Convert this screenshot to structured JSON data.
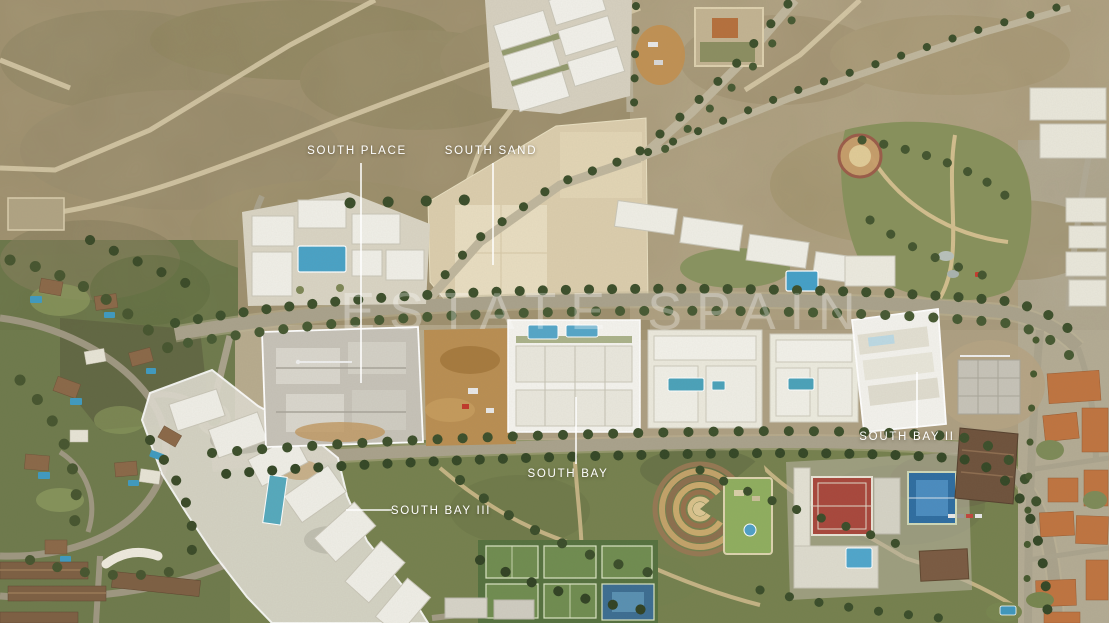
{
  "title": "Aerial view of South development area",
  "watermark": {
    "text": "ESTATE SPAIN",
    "color": "#ffffff",
    "opacity": 0.3
  },
  "labels": [
    {
      "id": "south-place",
      "text": "SOUTH PLACE",
      "x": 357,
      "y": 151,
      "leader": {
        "x1": 361,
        "y1": 163,
        "x2": 361,
        "y2": 383
      }
    },
    {
      "id": "south-sand",
      "text": "SOUTH SAND",
      "x": 491,
      "y": 151,
      "leader": {
        "x1": 493,
        "y1": 163,
        "x2": 493,
        "y2": 265
      }
    },
    {
      "id": "south-bay",
      "text": "SOUTH BAY",
      "x": 568,
      "y": 474,
      "leader": {
        "x1": 576,
        "y1": 397,
        "x2": 576,
        "y2": 464
      }
    },
    {
      "id": "south-bay-ii",
      "text": "SOUTH BAY II",
      "x": 907,
      "y": 437,
      "leader": {
        "x1": 917,
        "y1": 372,
        "x2": 917,
        "y2": 428
      }
    },
    {
      "id": "south-bay-iii",
      "text": "SOUTH BAY III",
      "x": 441,
      "y": 511,
      "leader": {
        "x1": 346,
        "y1": 510,
        "x2": 392,
        "y2": 510
      }
    }
  ],
  "palette": {
    "scrubland": "#a39573",
    "sand_plot": "#dbcdad",
    "road": "#a9a28c",
    "tree_green": "#3c4f2b",
    "pool_blue": "#4aa2c6",
    "park_green": "#75804e",
    "villa_green": "#6e7a4c",
    "roof_orange": "#bf7440",
    "parcel_outline": "#ffffff",
    "label_text": "#ffffff"
  }
}
